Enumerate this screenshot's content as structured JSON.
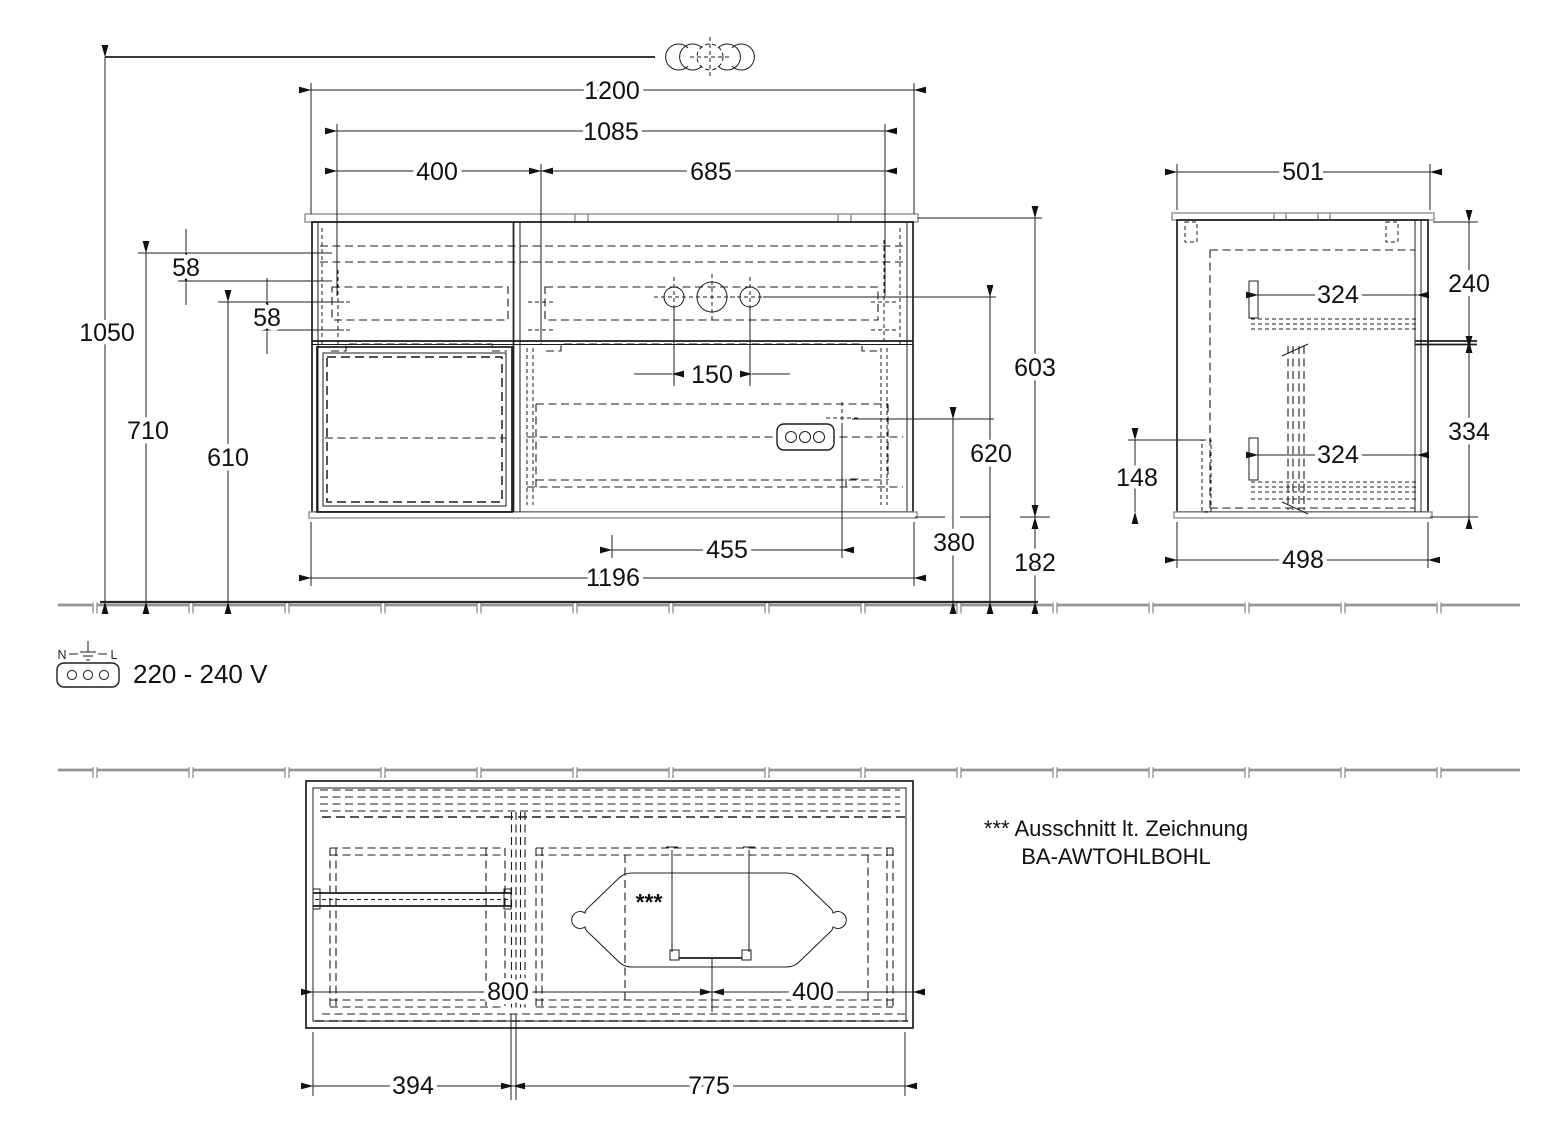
{
  "dims": {
    "front": {
      "total_width": "1200",
      "fixing_width": "1085",
      "fixing_left": "400",
      "fixing_right": "685",
      "height_top": "1050",
      "height_fix_upper": "710",
      "height_fix_lower": "610",
      "offset_upper": "58",
      "offset_lower": "58",
      "tap_spacing": "150",
      "body_height": "603",
      "outlet_height": "620",
      "socket_height": "380",
      "bottom_clearance": "182",
      "trap_offset": "455",
      "body_width": "1196"
    },
    "side": {
      "depth_top": "501",
      "upper_section": "240",
      "rail_upper": "324",
      "lower_section": "334",
      "rail_lower": "324",
      "recess_height": "148",
      "depth_body": "498"
    },
    "top": {
      "drain_from_left": "800",
      "drain_from_right": "400",
      "left_section": "394",
      "right_section": "775"
    }
  },
  "notes": {
    "cutout_marker": "***",
    "cutout_line1": "*** Ausschnitt lt. Zeichnung",
    "cutout_line2": "BA-AWTOHLBOHL",
    "voltage": "220 - 240 V",
    "plug_neutral": "N",
    "plug_line": "L"
  }
}
